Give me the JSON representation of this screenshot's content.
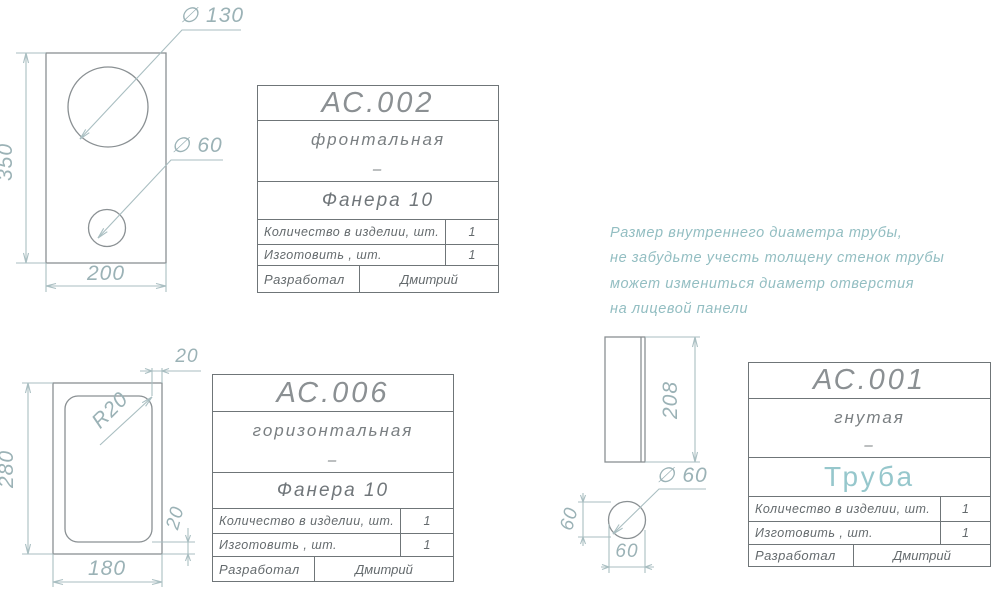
{
  "drawing_note": {
    "lines": [
      "Размер  внутреннего  диаметра  трубы,",
      "не  забудьте  учесть  толщену  стенок  трубы",
      "может  измениться  диаметр  отверстия",
      "на  лицевой  панели"
    ]
  },
  "title_blocks": [
    {
      "code": "АС.002",
      "name": "фронтальная",
      "dash": "–",
      "material": "Фанера  10",
      "rows": [
        {
          "label": "Количество  в  изделии,  шт.",
          "value": "1"
        },
        {
          "label": "Изготовить  ,  шт.",
          "value": "1"
        },
        {
          "label": "Разработал",
          "value": "Дмитрий"
        }
      ]
    },
    {
      "code": "АС.006",
      "name": "горизонтальная",
      "dash": "–",
      "material": "Фанера  10",
      "rows": [
        {
          "label": "Количество  в  изделии,  шт.",
          "value": "1"
        },
        {
          "label": "Изготовить  ,  шт.",
          "value": "1"
        },
        {
          "label": "Разработал",
          "value": "Дмитрий"
        }
      ]
    },
    {
      "code": "АС.001",
      "name": "гнутая",
      "dash": "–",
      "material": "Труба",
      "rows": [
        {
          "label": "Количество  в  изделии,  шт.",
          "value": "1"
        },
        {
          "label": "Изготовить  ,  шт.",
          "value": "1"
        },
        {
          "label": "Разработал",
          "value": "Дмитрий"
        }
      ]
    }
  ],
  "dimensions": {
    "front_panel": {
      "height": "350",
      "width": "200",
      "large_hole": "∅ 130",
      "small_hole": "∅ 60"
    },
    "horizontal_panel": {
      "height": "280",
      "width": "180",
      "edge_offset_top": "20",
      "edge_offset_bottom": "20",
      "corner_radius": "R20"
    },
    "tube_side": {
      "length": "208"
    },
    "tube_section": {
      "diameter": "∅ 60",
      "width": "60",
      "height": "60"
    }
  },
  "colors": {
    "background": "#ffffff",
    "outline": "#8a9093",
    "dimension_line": "#a9bec1",
    "dimension_text": "#9bb2b6",
    "note_text": "#93bec2",
    "accent_teal": "#96c7cc",
    "table_border": "#6f7578",
    "table_text": "#646a6d"
  }
}
